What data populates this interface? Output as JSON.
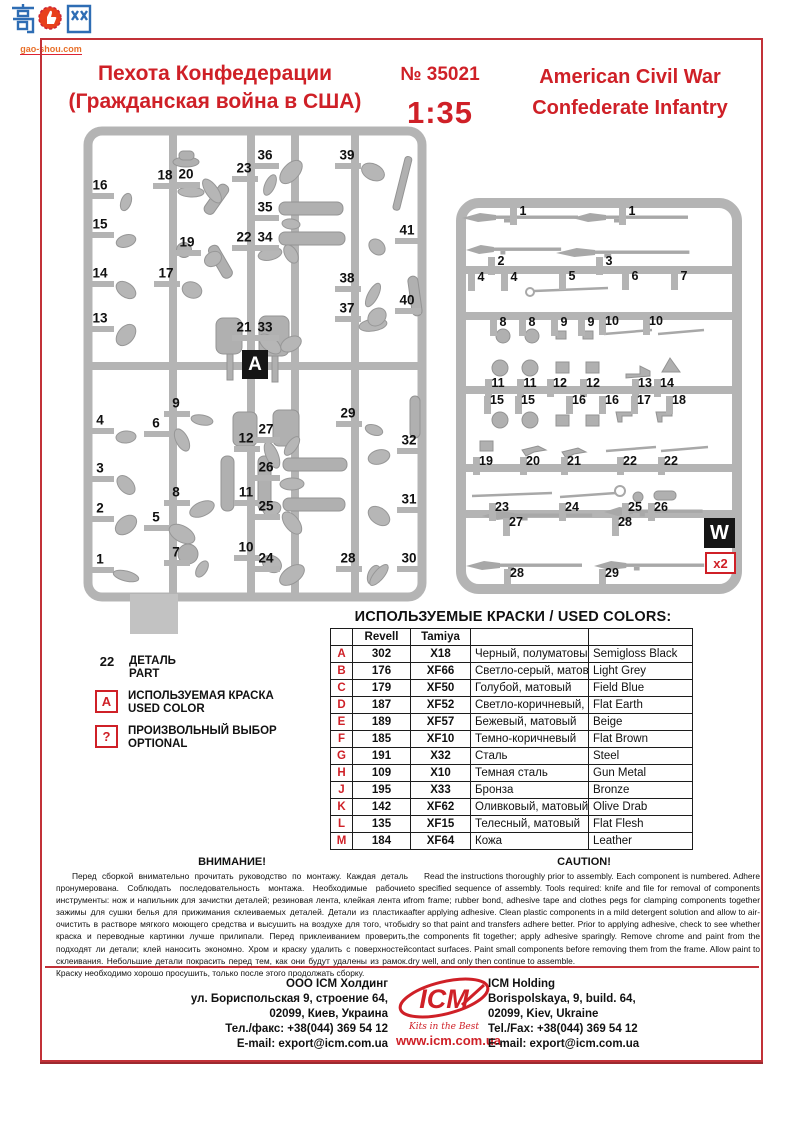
{
  "watermark": {
    "char_left": "高",
    "char_right": "网",
    "domain": "gao-shou.com"
  },
  "header": {
    "title_ru_line1": "Пехота Конфедерации",
    "title_ru_line2": "(Гражданская война в США)",
    "kit_number": "№ 35021",
    "scale": "1:35",
    "title_en": "American Civil War Confederate Infantry"
  },
  "sprues": {
    "a": {
      "tag": "A",
      "labels": [
        {
          "t": "16",
          "x": 17,
          "y": 59
        },
        {
          "t": "15",
          "x": 17,
          "y": 98
        },
        {
          "t": "14",
          "x": 17,
          "y": 147
        },
        {
          "t": "13",
          "x": 17,
          "y": 192
        },
        {
          "t": "18",
          "x": 82,
          "y": 49
        },
        {
          "t": "20",
          "x": 103,
          "y": 48
        },
        {
          "t": "19",
          "x": 104,
          "y": 116
        },
        {
          "t": "17",
          "x": 83,
          "y": 147
        },
        {
          "t": "23",
          "x": 161,
          "y": 42
        },
        {
          "t": "22",
          "x": 161,
          "y": 111
        },
        {
          "t": "21",
          "x": 161,
          "y": 201
        },
        {
          "t": "36",
          "x": 182,
          "y": 29
        },
        {
          "t": "35",
          "x": 182,
          "y": 81
        },
        {
          "t": "34",
          "x": 182,
          "y": 111
        },
        {
          "t": "33",
          "x": 182,
          "y": 201
        },
        {
          "t": "39",
          "x": 264,
          "y": 29
        },
        {
          "t": "38",
          "x": 264,
          "y": 152
        },
        {
          "t": "37",
          "x": 264,
          "y": 182
        },
        {
          "t": "41",
          "x": 324,
          "y": 104
        },
        {
          "t": "40",
          "x": 324,
          "y": 174
        },
        {
          "t": "9",
          "x": 93,
          "y": 277
        },
        {
          "t": "6",
          "x": 73,
          "y": 297
        },
        {
          "t": "8",
          "x": 93,
          "y": 366
        },
        {
          "t": "5",
          "x": 73,
          "y": 391
        },
        {
          "t": "7",
          "x": 93,
          "y": 426
        },
        {
          "t": "4",
          "x": 17,
          "y": 294
        },
        {
          "t": "3",
          "x": 17,
          "y": 342
        },
        {
          "t": "2",
          "x": 17,
          "y": 382
        },
        {
          "t": "1",
          "x": 17,
          "y": 433
        },
        {
          "t": "12",
          "x": 163,
          "y": 312
        },
        {
          "t": "11",
          "x": 163,
          "y": 366
        },
        {
          "t": "10",
          "x": 163,
          "y": 421
        },
        {
          "t": "27",
          "x": 183,
          "y": 303
        },
        {
          "t": "26",
          "x": 183,
          "y": 341
        },
        {
          "t": "25",
          "x": 183,
          "y": 380
        },
        {
          "t": "24",
          "x": 183,
          "y": 432
        },
        {
          "t": "29",
          "x": 265,
          "y": 287
        },
        {
          "t": "28",
          "x": 265,
          "y": 432
        },
        {
          "t": "32",
          "x": 326,
          "y": 314
        },
        {
          "t": "31",
          "x": 326,
          "y": 373
        },
        {
          "t": "30",
          "x": 326,
          "y": 432
        }
      ]
    },
    "w": {
      "tag": "W",
      "multiplier": "x2",
      "labels": [
        {
          "t": "1",
          "x": 67,
          "y": 13
        },
        {
          "t": "1",
          "x": 176,
          "y": 13
        },
        {
          "t": "2",
          "x": 45,
          "y": 63
        },
        {
          "t": "3",
          "x": 153,
          "y": 63
        },
        {
          "t": "4",
          "x": 25,
          "y": 79
        },
        {
          "t": "4",
          "x": 58,
          "y": 79
        },
        {
          "t": "5",
          "x": 116,
          "y": 78
        },
        {
          "t": "6",
          "x": 179,
          "y": 78
        },
        {
          "t": "7",
          "x": 228,
          "y": 78
        },
        {
          "t": "8",
          "x": 47,
          "y": 124
        },
        {
          "t": "8",
          "x": 76,
          "y": 124
        },
        {
          "t": "9",
          "x": 108,
          "y": 124
        },
        {
          "t": "9",
          "x": 135,
          "y": 124
        },
        {
          "t": "10",
          "x": 156,
          "y": 123
        },
        {
          "t": "10",
          "x": 200,
          "y": 123
        },
        {
          "t": "11",
          "x": 42,
          "y": 185
        },
        {
          "t": "11",
          "x": 74,
          "y": 185
        },
        {
          "t": "12",
          "x": 104,
          "y": 185
        },
        {
          "t": "12",
          "x": 137,
          "y": 185
        },
        {
          "t": "13",
          "x": 189,
          "y": 185
        },
        {
          "t": "14",
          "x": 211,
          "y": 185
        },
        {
          "t": "15",
          "x": 41,
          "y": 202
        },
        {
          "t": "15",
          "x": 72,
          "y": 202
        },
        {
          "t": "16",
          "x": 123,
          "y": 202
        },
        {
          "t": "16",
          "x": 156,
          "y": 202
        },
        {
          "t": "17",
          "x": 188,
          "y": 202
        },
        {
          "t": "18",
          "x": 223,
          "y": 202
        },
        {
          "t": "19",
          "x": 30,
          "y": 263
        },
        {
          "t": "20",
          "x": 77,
          "y": 263
        },
        {
          "t": "21",
          "x": 118,
          "y": 263
        },
        {
          "t": "22",
          "x": 174,
          "y": 263
        },
        {
          "t": "22",
          "x": 215,
          "y": 263
        },
        {
          "t": "23",
          "x": 46,
          "y": 309
        },
        {
          "t": "24",
          "x": 116,
          "y": 309
        },
        {
          "t": "25",
          "x": 179,
          "y": 309
        },
        {
          "t": "26",
          "x": 205,
          "y": 309
        },
        {
          "t": "27",
          "x": 60,
          "y": 324
        },
        {
          "t": "28",
          "x": 169,
          "y": 324
        },
        {
          "t": "28",
          "x": 61,
          "y": 375
        },
        {
          "t": "29",
          "x": 156,
          "y": 375
        }
      ]
    }
  },
  "legend": {
    "part_number_example": "22",
    "part_ru": "ДЕТАЛЬ",
    "part_en": "PART",
    "color_symbol": "A",
    "color_ru": "ИСПОЛЬЗУЕМАЯ КРАСКА",
    "color_en": "USED COLOR",
    "optional_symbol": "?",
    "optional_ru": "ПРОИЗВОЛЬНЫЙ ВЫБОР",
    "optional_en": "OPTIONAL"
  },
  "colors_table": {
    "title": "ИСПОЛЬЗУЕМЫЕ КРАСКИ / USED COLORS:",
    "columns": [
      "",
      "Revell",
      "Tamiya",
      "",
      ""
    ],
    "rows": [
      {
        "letter": "A",
        "revell": "302",
        "tamiya": "X18",
        "name_ru": "Черный, полуматовый",
        "name_en": "Semigloss Black"
      },
      {
        "letter": "B",
        "revell": "176",
        "tamiya": "XF66",
        "name_ru": "Светло-серый, матовый",
        "name_en": "Light Grey"
      },
      {
        "letter": "C",
        "revell": "179",
        "tamiya": "XF50",
        "name_ru": "Голубой, матовый",
        "name_en": "Field Blue"
      },
      {
        "letter": "D",
        "revell": "187",
        "tamiya": "XF52",
        "name_ru": "Светло-коричневый, мат.",
        "name_en": "Flat Earth"
      },
      {
        "letter": "E",
        "revell": "189",
        "tamiya": "XF57",
        "name_ru": "Бежевый, матовый",
        "name_en": "Beige"
      },
      {
        "letter": "F",
        "revell": "185",
        "tamiya": "XF10",
        "name_ru": "Темно-коричневый",
        "name_en": "Flat Brown"
      },
      {
        "letter": "G",
        "revell": "191",
        "tamiya": "X32",
        "name_ru": "Сталь",
        "name_en": "Steel"
      },
      {
        "letter": "H",
        "revell": "109",
        "tamiya": "X10",
        "name_ru": "Темная сталь",
        "name_en": "Gun Metal"
      },
      {
        "letter": "J",
        "revell": "195",
        "tamiya": "X33",
        "name_ru": "Бронза",
        "name_en": "Bronze"
      },
      {
        "letter": "K",
        "revell": "142",
        "tamiya": "XF62",
        "name_ru": "Оливковый, матовый",
        "name_en": "Olive Drab"
      },
      {
        "letter": "L",
        "revell": "135",
        "tamiya": "XF15",
        "name_ru": "Телесный, матовый",
        "name_en": "Flat Flesh"
      },
      {
        "letter": "M",
        "revell": "184",
        "tamiya": "XF64",
        "name_ru": "Кожа",
        "name_en": "Leather"
      }
    ]
  },
  "caution_ru": {
    "title": "ВНИМАНИЕ!",
    "body": "Перед сборкой внимательно прочитать руководство по монтажу. Каждая деталь пронумерована. Соблюдать последовательность монтажа. Необходимые рабочие инструменты: нож и напильник для зачистки деталей; резиновая лента, клейкая лента и зажимы для сушки белья для прижимания склеиваемых деталей. Детали из пластика очистить в растворе мягкого моющего средства и высушить на воздухе для того, чтобы краска и переводные картинки лучше прилипали. Перед приклеиванием проверить, подходят ли детали; клей наносить экономно. Хром и краску удалить с поверхностей склеивания. Небольшие детали покрасить перед тем, как они будут удалены из рамок. Краску необходимо хорошо просушить, только после этого продолжать сборку."
  },
  "caution_en": {
    "title": "CAUTION!",
    "body": "Read the instructions thoroughly prior to assembly. Each component is numbered. Adhere to specified sequence of assembly. Tools required: knife and file for removal of components from frame; rubber bond, adhesive tape and clothes pegs for clamping components together after applying adhesive. Clean plastic components in a mild detergent solution and allow to air-dry so that paint and transfers adhere better. Prior to applying adhesive, check to see whether the components fit together; apply adhesive sparingly. Remove chrome and paint from the contact surfaces. Paint small components before removing them from the frame. Allow paint to dry well, and only then continue to assemble."
  },
  "footer": {
    "ru_lines": [
      "ООО ICM Холдинг",
      "ул. Бориспольская 9, строение 64,",
      "02099, Киев, Украина",
      "Тел./факс: +38(044) 369 54 12",
      "E-mail: export@icm.com.ua"
    ],
    "en_lines": [
      "ICM Holding",
      "Borispolskaya, 9, build. 64,",
      "02099, Kiev, Ukraine",
      "Tel./Fax: +38(044) 369 54 12",
      "E-mail: export@icm.com.ua"
    ],
    "logo_text": "ICM",
    "logo_slogan": "Kits in the Best",
    "website": "www.icm.com.ua"
  },
  "theme": {
    "red": "#cf2027",
    "border_red": "#c23138",
    "sprue_gray": "#b4b4b4",
    "part_gray": "#b0b0b0"
  }
}
